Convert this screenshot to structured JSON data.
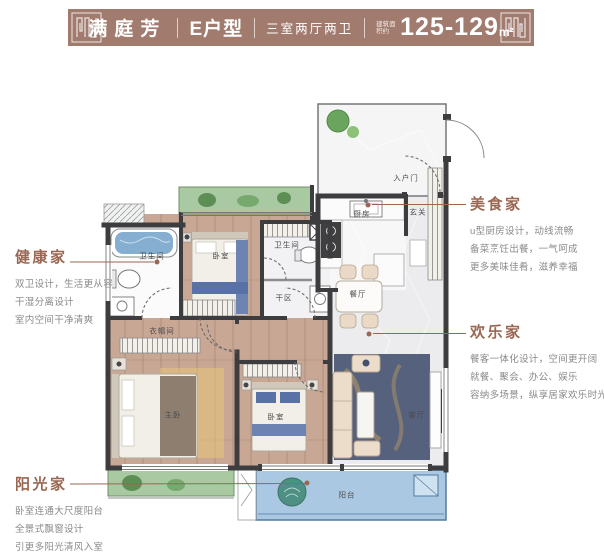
{
  "header": {
    "project_name": "满庭芳",
    "unit_type": "E户型",
    "layout_spec": "三室两厅两卫",
    "area_prefix": "建筑面积约",
    "area_value": "125-129",
    "area_unit": "m²"
  },
  "floorplan": {
    "rooms": {
      "entry_door": "入户门",
      "foyer": "玄关",
      "kitchen": "厨房",
      "dining": "餐厅",
      "living": "客厅",
      "balcony": "阳台",
      "master_bedroom": "主卧",
      "bedroom_mid": "卧室",
      "bedroom_bottom": "卧室",
      "bath_left": "卫生间",
      "bath_mid": "卫生间",
      "dry_area": "干区",
      "closet": "衣帽间"
    }
  },
  "annotations": {
    "health": {
      "title": "健康家",
      "lines": [
        "双卫设计，生活更从容",
        "干湿分离设计",
        "室内空间干净清爽"
      ]
    },
    "sunshine": {
      "title": "阳光家",
      "lines": [
        "卧室连通大尺度阳台",
        "全景式飘窗设计",
        "引更多阳光清风入室"
      ]
    },
    "gourmet": {
      "title": "美食家",
      "lines": [
        "u型厨房设计，动线流畅",
        "备菜烹饪出餐，一气呵成",
        "更多美味佳肴，滋养幸福"
      ]
    },
    "happy": {
      "title": "欢乐家",
      "lines": [
        "餐客一体化设计，空间更开阔",
        "就餐、聚会、办公、娱乐",
        "容纳多场景，纵享居家欢乐时光"
      ]
    }
  },
  "colors": {
    "band": "#a17b6e",
    "accent": "#9a6752",
    "body_text": "#8a8a8a",
    "wall": "#3d3d40",
    "wood_floor": "#c9a795",
    "marble_floor": "#ececee",
    "bay_green": "#a8c9a1",
    "balcony_blue": "#abc8e2",
    "rug_navy": "#55617d",
    "water_blue": "#85aed0"
  }
}
